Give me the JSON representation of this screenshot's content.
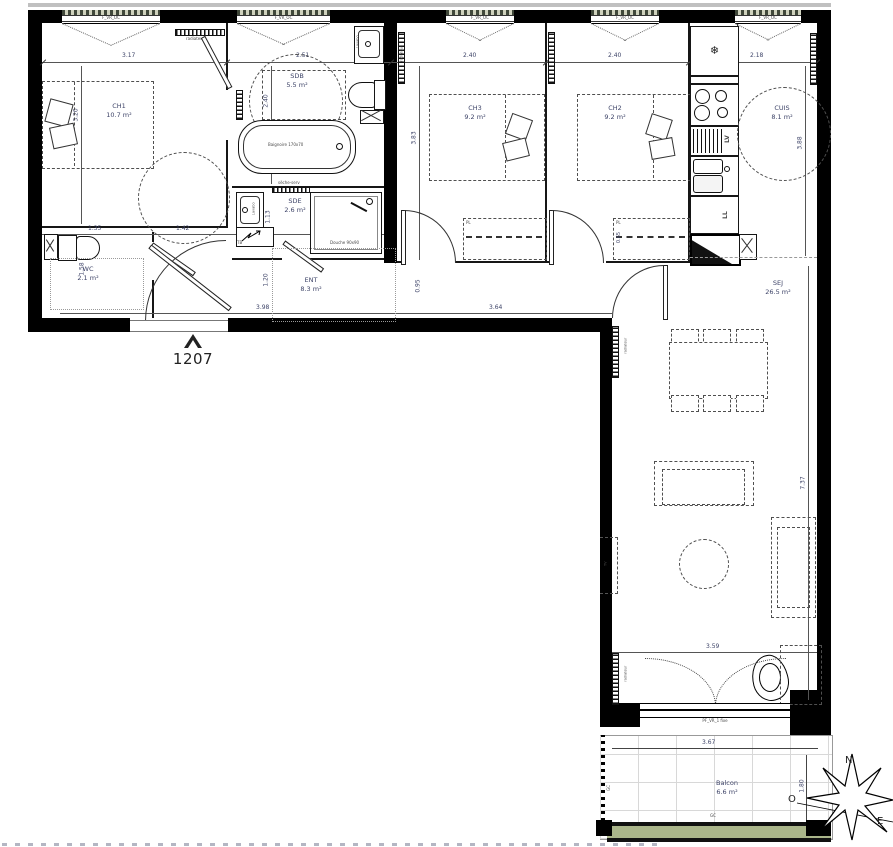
{
  "meta": {
    "unit_number": "1207"
  },
  "compass": {
    "north": "N",
    "west": "O",
    "east": "E"
  },
  "windows": {
    "top_label": "F_VR_OC",
    "bottom_label": "PF_VR_1 fixe"
  },
  "rooms": {
    "ch1": {
      "name": "CH1",
      "area": "10.7 m²"
    },
    "sdb": {
      "name": "SDB",
      "area": "5.5 m²"
    },
    "sde": {
      "name": "SDE",
      "area": "2.6 m²"
    },
    "wc": {
      "name": "WC",
      "area": "2.1 m²"
    },
    "ent": {
      "name": "ENT",
      "area": "8.3 m²"
    },
    "ch3": {
      "name": "CH3",
      "area": "9.2 m²"
    },
    "ch2": {
      "name": "CH2",
      "area": "9.2 m²"
    },
    "cuis": {
      "name": "CUIS",
      "area": "8.1 m²"
    },
    "sej": {
      "name": "SEJ",
      "area": "26.5 m²"
    },
    "balcon": {
      "name": "Balcon",
      "area": "6.6 m²"
    }
  },
  "dims": {
    "ch1_w": "3.17",
    "sdb_w": "2.51",
    "ch3_w": "2.40",
    "ch2_w": "2.40",
    "cuis_w": "2.18",
    "ch1_d": "3.20",
    "sdb_d": "2.40",
    "ch3_d": "3.83",
    "ch2_d": "3.18",
    "cuis_d": "3.88",
    "wc_w": "1.35",
    "ch1_b": "1.42",
    "sde_w": "1.88",
    "wc_d": "1.58",
    "sde_d": "1.13",
    "ent_d": "1.20",
    "ent_w": "3.98",
    "hall_w": "0.95",
    "hall_l": "3.64",
    "pl_d": "0.65",
    "sej_d": "7.37",
    "sej_w": "3.59",
    "balcon_w": "3.67",
    "balcon_d": "1.80"
  },
  "fixtures": {
    "bath": "Baignoire 170x70",
    "shower": "Douche 90x90",
    "radiator": "radiateur",
    "towel": "sèche-serv",
    "basin": "Lavabo",
    "dishwasher": "LV",
    "washer": "LL",
    "panel": "TB",
    "closet": "PL",
    "railing": "GC",
    "tv": "TV",
    "fridge_icon": "❄"
  }
}
